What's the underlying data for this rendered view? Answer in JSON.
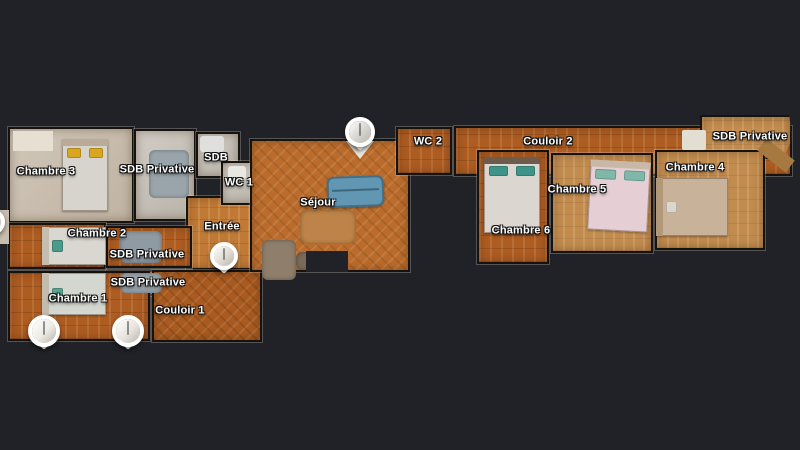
{
  "scene": {
    "background": "#202227",
    "label_color": "#ffffff",
    "wall_color": "#16120e",
    "accent_wood": "#ad5c22",
    "sofa_color": "#6297b3"
  },
  "floorplan": {
    "rooms": [
      {
        "name": "chambre-3",
        "label": "Chambre 3",
        "x": 8,
        "y": 127,
        "w": 126,
        "h": 96,
        "floor": "carpet",
        "lx": 46,
        "ly": 172
      },
      {
        "name": "sdb-privative-1",
        "label": "SDB Privative",
        "x": 134,
        "y": 129,
        "w": 62,
        "h": 92,
        "floor": "tile",
        "lx": 157,
        "ly": 170
      },
      {
        "name": "sdb",
        "label": "SDB",
        "x": 196,
        "y": 132,
        "w": 44,
        "h": 46,
        "floor": "tile",
        "lx": 216,
        "ly": 158
      },
      {
        "name": "entree",
        "label": "Entrée",
        "x": 186,
        "y": 196,
        "w": 76,
        "h": 74,
        "floor": "wood-light",
        "lx": 222,
        "ly": 227
      },
      {
        "name": "wc-1",
        "label": "WC 1",
        "x": 221,
        "y": 161,
        "w": 40,
        "h": 44,
        "floor": "tile",
        "lx": 239,
        "ly": 183
      },
      {
        "name": "chambre-2",
        "label": "Chambre 2",
        "x": 8,
        "y": 223,
        "w": 98,
        "h": 46,
        "floor": "wood",
        "lx": 97,
        "ly": 234
      },
      {
        "name": "sdb-privative-2",
        "label": "SDB Privative",
        "x": 106,
        "y": 226,
        "w": 86,
        "h": 42,
        "floor": "wood",
        "lx": 147,
        "ly": 255
      },
      {
        "name": "sdb-privative-3",
        "label": "SDB Privative",
        "x": 106,
        "y": 270,
        "w": 86,
        "h": 26,
        "floor": "wood",
        "lx": 148,
        "ly": 283
      },
      {
        "name": "chambre-1",
        "label": "Chambre 1",
        "x": 8,
        "y": 271,
        "w": 142,
        "h": 70,
        "floor": "wood",
        "lx": 78,
        "ly": 299
      },
      {
        "name": "couloir-1",
        "label": "Couloir 1",
        "x": 152,
        "y": 270,
        "w": 110,
        "h": 72,
        "floor": "herr",
        "lx": 180,
        "ly": 311
      },
      {
        "name": "sejour",
        "label": "Séjour",
        "x": 250,
        "y": 139,
        "w": 160,
        "h": 133,
        "floor": "herr-light",
        "lx": 318,
        "ly": 203
      },
      {
        "name": "wc-2",
        "label": "WC 2",
        "x": 396,
        "y": 127,
        "w": 56,
        "h": 48,
        "floor": "wood",
        "lx": 428,
        "ly": 142
      },
      {
        "name": "couloir-2",
        "label": "Couloir 2",
        "x": 454,
        "y": 126,
        "w": 338,
        "h": 50,
        "floor": "wood",
        "lx": 548,
        "ly": 142
      },
      {
        "name": "sdb-privative-4",
        "label": "SDB Privative",
        "x": 700,
        "y": 115,
        "w": 92,
        "h": 44,
        "floor": "tan",
        "lx": 750,
        "ly": 137,
        "clip": "polygon(0 0, 97% 0, 100% 55%, 90% 100%, 0 100%)"
      },
      {
        "name": "chambre-6",
        "label": "Chambre 6",
        "x": 477,
        "y": 150,
        "w": 72,
        "h": 114,
        "floor": "wood",
        "lx": 521,
        "ly": 231
      },
      {
        "name": "chambre-5",
        "label": "Chambre 5",
        "x": 551,
        "y": 153,
        "w": 102,
        "h": 100,
        "floor": "tan",
        "lx": 577,
        "ly": 190
      },
      {
        "name": "chambre-4",
        "label": "Chambre 4",
        "x": 655,
        "y": 150,
        "w": 110,
        "h": 100,
        "floor": "tan",
        "lx": 695,
        "ly": 168
      }
    ],
    "furniture": [
      {
        "kind": "block",
        "name": "wardrobe",
        "x": 13,
        "y": 131,
        "w": 40,
        "h": 20,
        "color": "#e7e0d2"
      },
      {
        "kind": "block",
        "name": "wall-stub",
        "x": 0,
        "y": 210,
        "w": 9,
        "h": 34,
        "color": "#c7bdae"
      },
      {
        "kind": "bed",
        "name": "bed-chambre-3",
        "x": 62,
        "y": 139,
        "w": 46,
        "h": 72,
        "cover": "#d7d3cd",
        "pillow": "#d9a622",
        "orient": "v",
        "head": "#b9ab97"
      },
      {
        "kind": "bed",
        "name": "bed-chambre-2",
        "x": 42,
        "y": 227,
        "w": 64,
        "h": 38,
        "cover": "#dad6d0",
        "pillow": "#4b9a8c",
        "orient": "h",
        "head": "#c5bdb0"
      },
      {
        "kind": "bed",
        "name": "bed-chambre-1",
        "x": 42,
        "y": 273,
        "w": 64,
        "h": 42,
        "cover": "#d4d7cf",
        "pillow": "#59a190",
        "orient": "h",
        "head": "#c2bbae"
      },
      {
        "kind": "blob",
        "name": "shower",
        "x": 149,
        "y": 150,
        "w": 40,
        "h": 48,
        "color": "#9aa5ab"
      },
      {
        "kind": "blob",
        "name": "shower",
        "x": 120,
        "y": 231,
        "w": 42,
        "h": 32,
        "color": "#8f9aa3"
      },
      {
        "kind": "blob",
        "name": "shower",
        "x": 120,
        "y": 273,
        "w": 42,
        "h": 20,
        "color": "#98a2a9"
      },
      {
        "kind": "block",
        "name": "toilet",
        "x": 228,
        "y": 166,
        "w": 18,
        "h": 13,
        "color": "#e9e7e2",
        "radius": 3
      },
      {
        "kind": "block",
        "name": "sink",
        "x": 200,
        "y": 136,
        "w": 24,
        "h": 16,
        "color": "#dfe0dd",
        "radius": 3
      },
      {
        "kind": "blob",
        "name": "rug",
        "x": 300,
        "y": 210,
        "w": 56,
        "h": 34,
        "color": "#bd8348",
        "radius": 8
      },
      {
        "kind": "sofa",
        "name": "sofa",
        "x": 327,
        "y": 176,
        "w": 57,
        "h": 31,
        "color": "#6297b3",
        "rotate": -2
      },
      {
        "kind": "blob",
        "name": "furniture-blob",
        "x": 262,
        "y": 240,
        "w": 34,
        "h": 40,
        "color": "#8e7e6b"
      },
      {
        "kind": "blob",
        "name": "furniture-blob",
        "x": 296,
        "y": 252,
        "w": 22,
        "h": 18,
        "color": "#7a6a58"
      },
      {
        "kind": "block",
        "name": "screen",
        "x": 346,
        "y": 141,
        "w": 28,
        "h": 18,
        "color": "#e6e3dc",
        "clip": "polygon(0 0, 100% 0, 50% 100%)"
      },
      {
        "kind": "patch",
        "name": "wall-notch",
        "x": 306,
        "y": 251,
        "w": 42,
        "h": 21
      },
      {
        "kind": "bed",
        "name": "bed-chambre-6",
        "x": 484,
        "y": 157,
        "w": 56,
        "h": 76,
        "cover": "#dbd6cf",
        "pillow": "#3e9488",
        "orient": "v",
        "head": "#6d5c4b"
      },
      {
        "kind": "bed",
        "name": "bed-chambre-5",
        "x": 589,
        "y": 161,
        "w": 60,
        "h": 70,
        "cover": "#e5ced4",
        "pillow": "#7fb8a8",
        "orient": "v",
        "head": "#c9b8a8",
        "rotate": 3
      },
      {
        "kind": "bed",
        "name": "bed-chambre-4",
        "x": 656,
        "y": 178,
        "w": 72,
        "h": 58,
        "cover": "#c9b29a",
        "pillow": "#ded7c8",
        "orient": "h",
        "head": "#b09879"
      },
      {
        "kind": "block",
        "name": "shower",
        "x": 682,
        "y": 130,
        "w": 24,
        "h": 20,
        "color": "#e3ded2",
        "radius": 2
      },
      {
        "kind": "block",
        "name": "corridor-end",
        "x": 758,
        "y": 148,
        "w": 36,
        "h": 15,
        "color": "#a5793f",
        "rotate": 38
      }
    ],
    "markers": [
      {
        "name": "waypoint-sejour",
        "x": 360,
        "y": 132,
        "r": 15,
        "thumb": "#d6d4d0"
      },
      {
        "name": "waypoint-entree",
        "x": 224,
        "y": 256,
        "r": 14,
        "thumb": "#dfdbd3"
      },
      {
        "name": "waypoint-chambre-1a",
        "x": 44,
        "y": 331,
        "r": 16,
        "thumb": "#edebe6"
      },
      {
        "name": "waypoint-chambre-1b",
        "x": 128,
        "y": 331,
        "r": 16,
        "thumb": "#e8e4de"
      },
      {
        "name": "waypoint-edge",
        "x": -8,
        "y": 222,
        "r": 13,
        "thumb": "#e0ddd6",
        "partial": true
      }
    ]
  }
}
